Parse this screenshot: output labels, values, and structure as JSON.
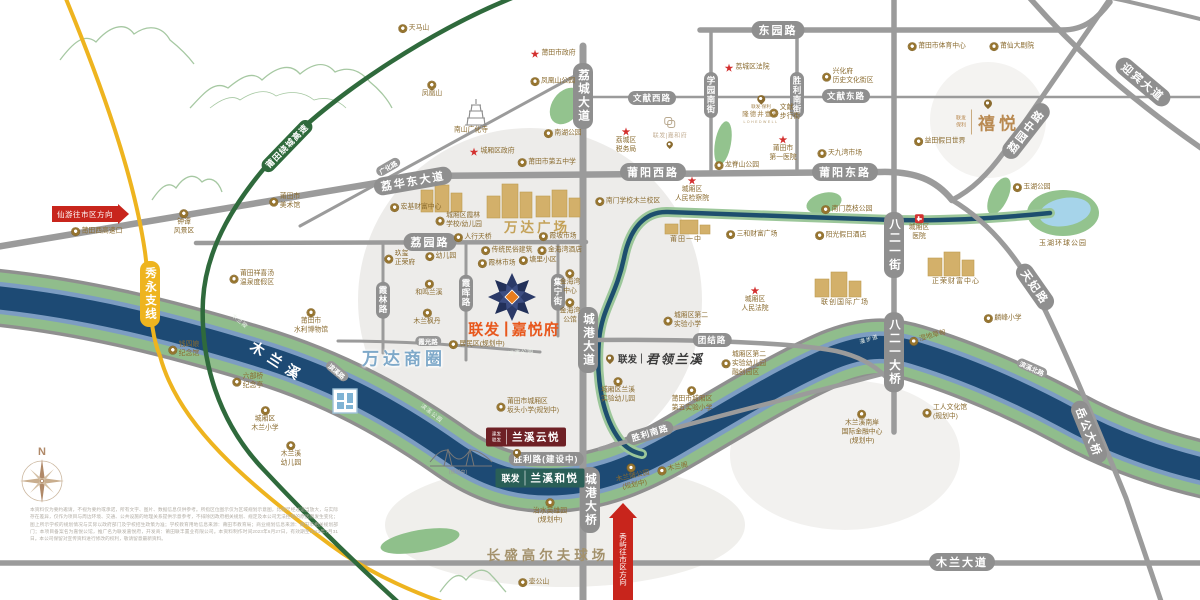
{
  "colors": {
    "road_gray": "#9b9b9b",
    "highway_green": "#2f6a3c",
    "highway_yellow": "#eeb41f",
    "river_water": "#1d4a74",
    "river_green": "#90bd8c",
    "river_slate": "#7d9dc2",
    "accent_orange": "#e8581d",
    "gold": "#8a6b2f",
    "watermark": "#edecea"
  },
  "compass": {
    "north": "N"
  },
  "arrows": {
    "xianyou": {
      "text": "仙游往市区方向"
    },
    "xiuyu": {
      "text": "秀屿往市区方向"
    }
  },
  "projects": {
    "jiayuefu": {
      "brand": "联发",
      "name": "嘉悦府"
    },
    "lanxi_yunyue": {
      "brand1": "建发",
      "brand2": "联发",
      "name": "兰溪云悦"
    },
    "lanxi_heyue": {
      "brand": "联发",
      "name": "兰溪和悦"
    },
    "junling_lanxi": {
      "brand": "联发",
      "name": "君领兰溪"
    },
    "xiyue": {
      "brand1": "联发",
      "brand2": "保利",
      "name": "禧悦"
    },
    "longdejing": {
      "line1": "联发·保利",
      "name": "隆德井壹号",
      "en": "LOHEDWELL"
    },
    "jiahefu": {
      "name": "联发|嘉和府"
    }
  },
  "disclaimer": {
    "text": "本资料仅为要约邀请，不视为要约或承诺，所有文字、图片、数据信息仅供参考。所指区位图示仅为区域规划示意图，比例尺经过适当放大，与实际存在差异，仅作为项目与周边环境、交通、公共设施的地理关系提供示意参考，不排除因政府相关规划、规定及本公司无法控制的原因而发生变化；图上所示学校的规划情况与实际以政府部门及学校招生政策为准；学校教育用地信息来源：莆田市教育局；商业规划信息来源：莆田市相关规划部门；本项目备案名为嘉悦公馆，推广名为联发嘉悦府，开发商：莆田联丰置业有限公司。本资料制作时间2023年6月27日，有效期至2023年7月31日。本公司保留对宣传资料进行修改的权利，敬请留意最新资料。"
  },
  "labels": [
    {
      "n": "rd-dongyuanlu",
      "t": "东园路",
      "c": "rh",
      "x": 778,
      "y": 30
    },
    {
      "n": "rd-wenxian-xilu",
      "t": "文献西路",
      "c": "rhs",
      "x": 652,
      "y": 98
    },
    {
      "n": "rd-wenxian-donglu",
      "t": "文献东路",
      "c": "rhs",
      "x": 846,
      "y": 96
    },
    {
      "n": "rd-puyang-xilu",
      "t": "莆阳西路",
      "c": "rh",
      "x": 653,
      "y": 172
    },
    {
      "n": "rd-puyang-donglu",
      "t": "莆阳东路",
      "c": "rh",
      "x": 845,
      "y": 172
    },
    {
      "n": "rd-liyuanlu",
      "t": "荔园路",
      "c": "rh",
      "x": 430,
      "y": 242
    },
    {
      "n": "rd-lihuadong-dadao",
      "t": "荔华东大道",
      "c": "rh",
      "x": 413,
      "y": 181,
      "r": -10
    },
    {
      "n": "rd-guanghualu",
      "t": "广化路",
      "c": "rt",
      "x": 388,
      "y": 167,
      "r": -30
    },
    {
      "n": "rd-mulan-dadao",
      "t": "木兰大道",
      "c": "rh",
      "x": 962,
      "y": 562
    },
    {
      "n": "rd-tuanjielu",
      "t": "团结路",
      "c": "rhs",
      "x": 712,
      "y": 340
    },
    {
      "n": "rd-shenglilu",
      "t": "胜利路(建设中)",
      "c": "rhs",
      "x": 546,
      "y": 459
    },
    {
      "n": "rd-shengli-nanlu",
      "t": "胜利南路",
      "c": "rhs",
      "x": 650,
      "y": 433,
      "r": -17
    },
    {
      "n": "rd-binxi-beilu",
      "t": "滨溪北路",
      "c": "rt",
      "x": 1032,
      "y": 368,
      "r": 24
    },
    {
      "n": "rd-binxilu",
      "t": "滨溪路",
      "c": "rt",
      "x": 337,
      "y": 371,
      "r": 40
    },
    {
      "n": "rd-xiaguanglu",
      "t": "霞光路",
      "c": "rt",
      "x": 428,
      "y": 341
    },
    {
      "n": "rd-licheng-dadao",
      "t": "荔城大道",
      "c": "rv",
      "x": 583,
      "y": 96
    },
    {
      "n": "rd-xueyuan-nanjie",
      "t": "学园南街",
      "c": "rvs",
      "x": 711,
      "y": 95
    },
    {
      "n": "rd-shengli-nanjie",
      "t": "胜利南街",
      "c": "rvs",
      "x": 797,
      "y": 95
    },
    {
      "n": "rd-bayeryi-jie",
      "t": "八二一街",
      "c": "rv",
      "x": 894,
      "y": 245
    },
    {
      "n": "rd-bayeryi-daqiao",
      "t": "八二一大桥",
      "c": "rv",
      "x": 894,
      "y": 352
    },
    {
      "n": "rd-chenggang-dadao",
      "t": "城港大道",
      "c": "rv",
      "x": 588,
      "y": 340
    },
    {
      "n": "rd-chenggang-daqiao",
      "t": "城港大桥",
      "c": "rv",
      "x": 590,
      "y": 500
    },
    {
      "n": "rd-jiningjie",
      "t": "集宁街",
      "c": "rvs",
      "x": 558,
      "y": 292
    },
    {
      "n": "rd-xialinlu",
      "t": "霞林路",
      "c": "rvs",
      "x": 383,
      "y": 300
    },
    {
      "n": "rd-xiahuilu",
      "t": "霞晖路",
      "c": "rvs",
      "x": 466,
      "y": 293
    },
    {
      "n": "rd-liyuan-zhonglu",
      "t": "荔园中路",
      "c": "rh",
      "x": 1026,
      "y": 131,
      "r": -52
    },
    {
      "n": "rd-tianfeilu",
      "t": "天妃路",
      "c": "rh",
      "x": 1035,
      "y": 287,
      "r": 55
    },
    {
      "n": "rd-yuegong-daqiao",
      "t": "岳公大桥",
      "c": "rh",
      "x": 1089,
      "y": 432,
      "r": 68
    },
    {
      "n": "rd-yingbin-dadao",
      "t": "迎宾大道",
      "c": "rh",
      "x": 1143,
      "y": 82,
      "r": 40
    },
    {
      "n": "rd-xiuyong-zhixian",
      "t": "秀永支线",
      "c": "rv hwy",
      "x": 150,
      "y": 294
    },
    {
      "n": "rd-raocheng-gaosu",
      "t": "莆田绕城高速",
      "c": "rhs hwg",
      "x": 287,
      "y": 146,
      "r": -46
    },
    {
      "n": "river-mulanxi",
      "t": "木兰溪",
      "c": "river",
      "x": 278,
      "y": 362,
      "r": 33
    },
    {
      "n": "poi-mulanbei",
      "t": "木兰陂",
      "c": "bank",
      "x": 240,
      "y": 321,
      "r": 40
    },
    {
      "n": "poi-hebin-gongyuan",
      "t": "河滨公园",
      "c": "bank",
      "x": 521,
      "y": 352,
      "r": -6
    },
    {
      "n": "poi-binxi-gongyuan",
      "t": "滨溪公园",
      "c": "bank",
      "x": 432,
      "y": 413,
      "r": 38
    },
    {
      "n": "poi-manbudao",
      "t": "漫步道",
      "c": "bank",
      "x": 869,
      "y": 339,
      "r": -17
    },
    {
      "n": "note-bridge-planned",
      "t": "(规划中)",
      "c": "banks",
      "x": 458,
      "y": 472
    },
    {
      "n": "poi-tianmashan",
      "t": "天马山",
      "c": "poi",
      "x": 414,
      "y": 29
    },
    {
      "n": "poi-fenghuangshan",
      "t": "凤凰山",
      "c": "poiu",
      "x": 432,
      "y": 90
    },
    {
      "n": "poi-fenghuangshan-gongyuan",
      "t": "凤凰山公园",
      "c": "poi",
      "x": 553,
      "y": 82
    },
    {
      "n": "poi-putian-shizhengfu",
      "t": "莆田市政府",
      "c": "gov",
      "x": 553,
      "y": 54
    },
    {
      "n": "poi-nanshan-guanghuasi",
      "t": "南山广化寺",
      "c": "poi",
      "i": "",
      "x": 471,
      "y": 131
    },
    {
      "n": "poi-nanhu-gongyuan",
      "t": "南湖公园",
      "c": "poi",
      "x": 563,
      "y": 134
    },
    {
      "n": "poi-chengxiangqu-zhengfu",
      "t": "城厢区政府",
      "c": "gov",
      "x": 492,
      "y": 152
    },
    {
      "n": "poi-diwu-zhongxue",
      "t": "莆田市第五中学",
      "c": "poi",
      "x": 547,
      "y": 163
    },
    {
      "n": "poi-zhongtan-fengjingqu",
      "t": "钟谭\n风景区",
      "c": "poiu",
      "x": 184,
      "y": 223
    },
    {
      "n": "poi-putianxi-gaosukou",
      "t": "莆田西高速口",
      "c": "poi",
      "x": 97,
      "y": 232
    },
    {
      "n": "poi-meishuguan",
      "t": "莆田市\n美术馆",
      "c": "poi",
      "x": 285,
      "y": 202
    },
    {
      "n": "poi-xiangxitang",
      "t": "莆田祥喜汤\n温泉度假区",
      "c": "poi",
      "x": 252,
      "y": 279
    },
    {
      "n": "poi-qiansiniang",
      "t": "钱四娘\n纪念馆",
      "c": "poi",
      "x": 184,
      "y": 350
    },
    {
      "n": "poi-liubuqiao",
      "t": "六部桥\n纪念亭",
      "c": "poi",
      "x": 248,
      "y": 382
    },
    {
      "n": "poi-mulan-xiaoxue",
      "t": "城厢区\n木兰小学",
      "c": "poiu",
      "x": 265,
      "y": 420
    },
    {
      "n": "poi-mulanxi-youeryuan",
      "t": "木兰溪\n幼儿园",
      "c": "poiu",
      "x": 291,
      "y": 455
    },
    {
      "n": "poi-shuili-bowuguan",
      "t": "莆田市\n水利博物馆",
      "c": "poiu",
      "x": 311,
      "y": 322
    },
    {
      "n": "poi-hongji-caifu",
      "t": "宏基财富中心",
      "c": "poi",
      "x": 416,
      "y": 208
    },
    {
      "n": "poi-xialin-xuexiao",
      "t": "城厢区霞林\n学校/幼儿园",
      "c": "poi",
      "x": 459,
      "y": 221
    },
    {
      "n": "poi-youeryuan",
      "t": "幼儿园",
      "c": "poi",
      "x": 441,
      "y": 257
    },
    {
      "n": "poi-heming-lanxi",
      "t": "和鸣兰溪",
      "c": "poiu",
      "x": 429,
      "y": 289
    },
    {
      "n": "poi-mulan-fengdan",
      "t": "木兰枫丹",
      "c": "poiu",
      "x": 427,
      "y": 318
    },
    {
      "n": "poi-jiuxi-zhengrongfu",
      "t": "玖玺\n正荣府",
      "c": "poi",
      "x": 400,
      "y": 259
    },
    {
      "n": "poi-renxing-tianqiao",
      "t": "人行天桥",
      "c": "poi",
      "x": 473,
      "y": 238
    },
    {
      "n": "poi-chuantong-minsu",
      "t": "传统民俗建筑",
      "c": "poi",
      "x": 507,
      "y": 251
    },
    {
      "n": "poi-xiapo-shichang",
      "t": "霞坡市场",
      "c": "poi",
      "x": 558,
      "y": 237
    },
    {
      "n": "poi-jinhaiwan-jiudian",
      "t": "金海湾酒店",
      "c": "poi",
      "x": 560,
      "y": 251
    },
    {
      "n": "poi-xialin-shichang",
      "t": "霞林市场",
      "c": "poi",
      "x": 497,
      "y": 264
    },
    {
      "n": "poi-tangli-xiaoqu",
      "t": "塘里小区",
      "c": "poi",
      "x": 538,
      "y": 261
    },
    {
      "n": "poi-jinhaiwan-zhongxin",
      "t": "金海湾\n中心",
      "c": "poiu",
      "x": 570,
      "y": 283
    },
    {
      "n": "poi-jinhaiwan-gongguan",
      "t": "金海湾\n公馆",
      "c": "poiu",
      "x": 570,
      "y": 312
    },
    {
      "n": "poi-wanda-guangchang",
      "t": "万达广场",
      "c": "gbig",
      "x": 537,
      "y": 226
    },
    {
      "n": "area-wanda-shangquan",
      "t": "万达商圈",
      "c": "blue",
      "x": 404,
      "y": 357
    },
    {
      "n": "poi-nanmen-xuexiao",
      "t": "南门学校木兰校区",
      "c": "poi",
      "x": 628,
      "y": 202
    },
    {
      "n": "poi-renmin-jianchayuan",
      "t": "城厢区\n人民检察院",
      "c": "govu",
      "x": 692,
      "y": 190
    },
    {
      "n": "poi-putian-yizhong",
      "t": "莆田一中",
      "c": "gsm",
      "x": 686,
      "y": 239
    },
    {
      "n": "poi-sanhe-caifu",
      "t": "三和财富广场",
      "c": "poi",
      "x": 752,
      "y": 235
    },
    {
      "n": "poi-renmin-fayuan",
      "t": "城厢区\n人民法院",
      "c": "govu",
      "x": 755,
      "y": 300
    },
    {
      "n": "poi-yangguang-jiari",
      "t": "阳光假日酒店",
      "c": "poi",
      "x": 841,
      "y": 236
    },
    {
      "n": "poi-nanmen-lizhi",
      "t": "南门荔枝公园",
      "c": "poi",
      "x": 847,
      "y": 210
    },
    {
      "n": "poi-chengxiang-yiyuan",
      "t": "城厢区\n医院",
      "c": "hosp",
      "x": 919,
      "y": 228
    },
    {
      "n": "poi-zhengrong-caifu",
      "t": "正荣财富中心",
      "c": "gsm",
      "x": 956,
      "y": 281
    },
    {
      "n": "poi-lianchuang-guoji",
      "t": "联创国际广场",
      "c": "gsm",
      "x": 845,
      "y": 302
    },
    {
      "n": "poi-linfeng-xiaoxue",
      "t": "麟峰小学",
      "c": "poi",
      "x": 1003,
      "y": 319
    },
    {
      "n": "poi-yuhu-gongyuan",
      "t": "玉湖公园",
      "c": "poi",
      "x": 1032,
      "y": 188
    },
    {
      "n": "poi-yuhu-huanqiu",
      "t": "玉湖环球公园",
      "c": "gsm",
      "x": 1063,
      "y": 243
    },
    {
      "n": "poi-licheng-shuiwuju",
      "t": "荔城区\n税务局",
      "c": "govu",
      "x": 626,
      "y": 141
    },
    {
      "n": "poi-licheng-fayuan",
      "t": "荔城区法院",
      "c": "gov",
      "x": 747,
      "y": 68
    },
    {
      "n": "poi-diyi-yiyuan",
      "t": "莆田市\n第一医院",
      "c": "govu",
      "x": 783,
      "y": 149
    },
    {
      "n": "poi-wenxian-buxingjie",
      "t": "文献\n步行街",
      "c": "poi",
      "x": 785,
      "y": 113
    },
    {
      "n": "poi-xinghuafu",
      "t": "兴化府\n历史文化街区",
      "c": "poi",
      "x": 848,
      "y": 77
    },
    {
      "n": "poi-tiyu-zhongxin",
      "t": "莆田市体育中心",
      "c": "poi",
      "x": 937,
      "y": 47
    },
    {
      "n": "poi-puxian-dajuyuan",
      "t": "莆仙大剧院",
      "c": "poi",
      "x": 1012,
      "y": 47
    },
    {
      "n": "poi-yitian-jiari",
      "t": "益田假日世界",
      "c": "poi",
      "x": 940,
      "y": 142
    },
    {
      "n": "poi-tianjiuwan-shichang",
      "t": "天九湾市场",
      "c": "poi",
      "x": 840,
      "y": 154
    },
    {
      "n": "poi-longjishan",
      "t": "龙脊山公园",
      "c": "poi",
      "x": 737,
      "y": 166
    },
    {
      "n": "poi-dier-shiyan-xiaoxue",
      "t": "城厢区第二\n实验小学",
      "c": "poi",
      "x": 686,
      "y": 321
    },
    {
      "n": "poi-dier-shiyan-youeryuan",
      "t": "城厢区第二\n实验幼儿园\n融创园区",
      "c": "poi",
      "x": 744,
      "y": 364
    },
    {
      "n": "poi-lanxi-shiyan-youeryuan",
      "t": "城厢区兰溪\n实验幼儿园",
      "c": "poiu",
      "x": 618,
      "y": 391
    },
    {
      "n": "poi-diwu-shiyan-xiaoxue",
      "t": "莆田市城厢区\n第五实验小学",
      "c": "poiu",
      "x": 692,
      "y": 400
    },
    {
      "n": "poi-bantou-xiaoxue",
      "t": "莆田市城厢区\n坂头小学(规划中)",
      "c": "poi",
      "x": 528,
      "y": 407
    },
    {
      "n": "poi-zhishui-yingxiongyuan",
      "t": "治水英雄园\n(规划中)",
      "c": "poiu",
      "x": 550,
      "y": 512
    },
    {
      "n": "poi-changsheng-golf",
      "t": "长盛高尔夫球场",
      "c": "gbig2",
      "x": 548,
      "y": 554
    },
    {
      "n": "poi-hugongshan",
      "t": "壶公山",
      "c": "poi",
      "x": 534,
      "y": 583
    },
    {
      "n": "poi-gongren-wenhuaguan",
      "t": "工人文化馆\n(规划中)",
      "c": "poi",
      "x": 945,
      "y": 413
    },
    {
      "n": "poi-guoji-jinrong-zhongxin",
      "t": "木兰溪南岸\n国际金融中心\n(规划中)",
      "c": "poiu",
      "x": 862,
      "y": 428
    },
    {
      "n": "poi-mulanbei-gongyuan",
      "t": "木兰陂公园\n(规划中)",
      "c": "poiu",
      "x": 633,
      "y": 477,
      "r": -12
    },
    {
      "n": "poi-mulange",
      "t": "木兰阁",
      "c": "poi",
      "x": 673,
      "y": 469,
      "r": -12
    },
    {
      "n": "poi-shidi-caodian",
      "t": "湿地草甸",
      "c": "poi",
      "x": 928,
      "y": 338,
      "r": -15
    },
    {
      "n": "poi-juminqu",
      "t": "居民区(规划中)",
      "c": "poi",
      "x": 477,
      "y": 345
    }
  ]
}
